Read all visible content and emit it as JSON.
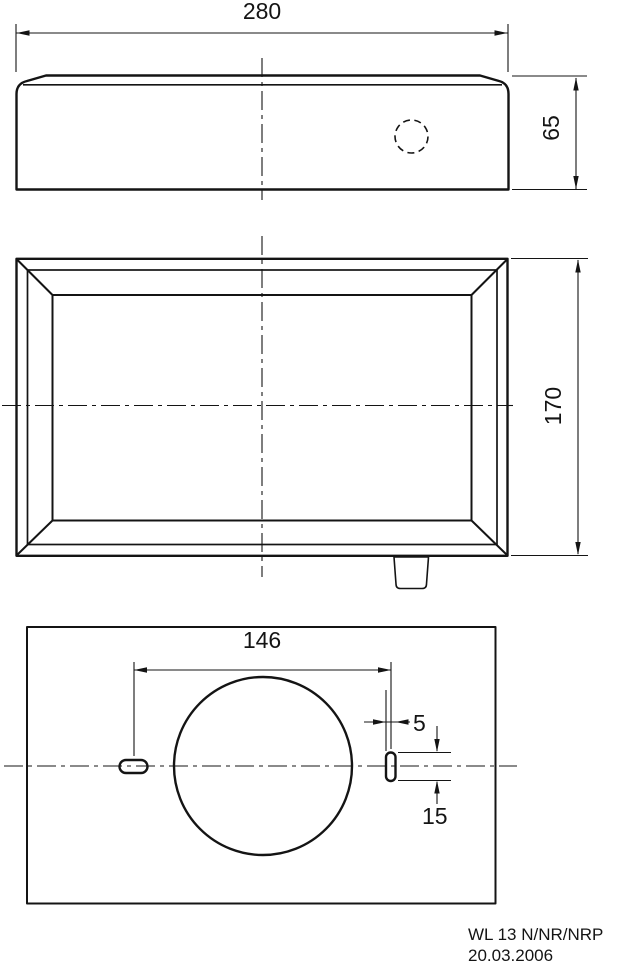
{
  "colors": {
    "line": "#141414",
    "background": "#ffffff"
  },
  "drawing": {
    "dim_width": "280",
    "dim_depth": "65",
    "dim_height": "170",
    "dim_hole_spacing": "146",
    "dim_slot_width": "5",
    "dim_slot_length": "15",
    "title": "WL 13 N/NR/NRP",
    "date": "20.03.2006"
  }
}
